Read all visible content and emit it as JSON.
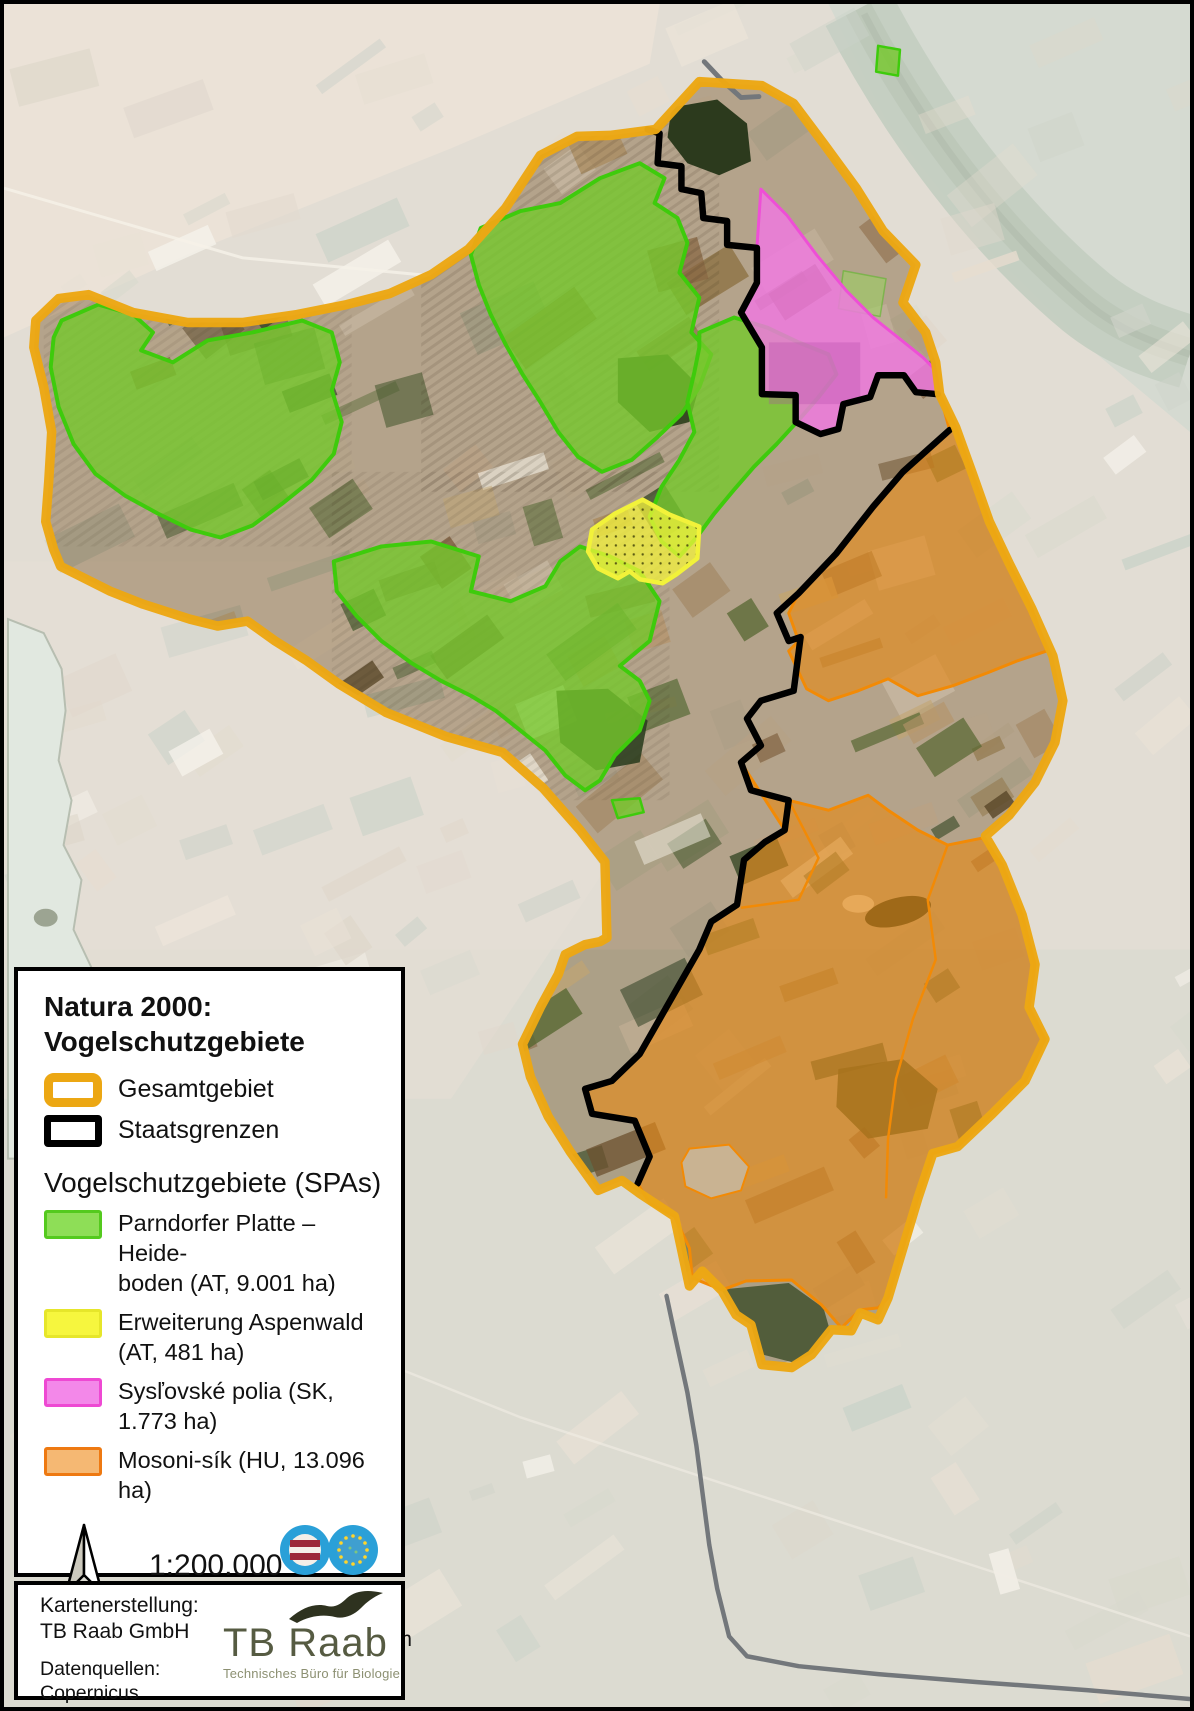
{
  "legend": {
    "title_line1": "Natura 2000:",
    "title_line2": "Vogelschutzgebiete",
    "outline_items": [
      {
        "label": "Gesamtgebiet"
      },
      {
        "label": "Staatsgrenzen"
      }
    ],
    "spa_heading": "Vogelschutzgebiete (SPAs)",
    "spa_items": [
      {
        "line1": "Parndorfer Platte – Heide-",
        "line2": "boden (AT, 9.001 ha)"
      },
      {
        "line1": "Erweiterung Aspenwald",
        "line2": "(AT, 481 ha)"
      },
      {
        "line1": "Sysľovské polia (SK,",
        "line2": "1.773 ha)"
      },
      {
        "line1": "Mosoni-sík (HU, 13.096 ha)",
        "line2": ""
      }
    ],
    "scale_ratio": "1:200.000",
    "membership_line1": "MITGLIED",
    "membership_line2": "DES FACHVERBANDES",
    "scalebar_labels": [
      "0",
      "2 000",
      "4 000",
      "6 000",
      "8 000 m"
    ]
  },
  "credits": {
    "made_by_label": "Kartenerstellung:",
    "made_by": "TB Raab GmbH",
    "sources_line1": "Datenquellen: Copernicus",
    "sources_line2": "Sentinel-Daten 2022, EEA",
    "logo_text": "TB Raab",
    "logo_subtitle": "Technisches Büro für Biologie"
  },
  "colors": {
    "gesamtgebiet_outline": "#ECA713",
    "staatsgrenzen": "#000000",
    "spa_green_fill": "#7FD23F",
    "spa_green_stroke": "#3DBF0A",
    "spa_yellow": "#F4F43C",
    "spa_pink_fill": "#F07FE2",
    "spa_pink_stroke": "#EE49D3",
    "spa_orange_fill": "#EFA244",
    "spa_orange_stroke": "#F28A05"
  }
}
